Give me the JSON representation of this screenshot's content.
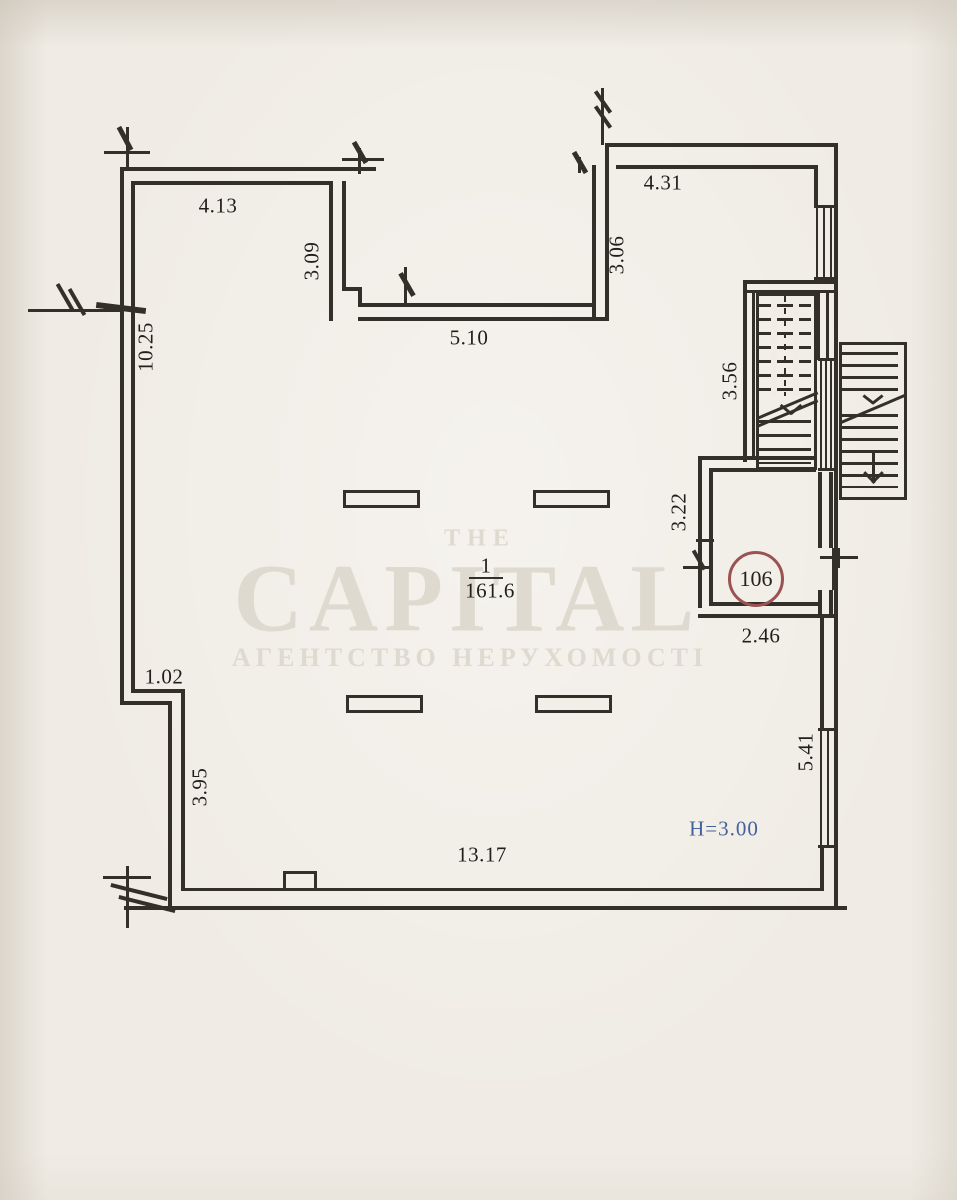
{
  "plan": {
    "dims": {
      "top_left_width": "4.13",
      "partition_height": "3.09",
      "inner_width": "5.10",
      "top_right_width": "4.31",
      "top_right_height": "3.06",
      "left_height": "10.25",
      "stair_height": "3.56",
      "room106_height": "3.22",
      "room106_width": "2.46",
      "left_step": "1.02",
      "left_lower_height": "3.95",
      "right_lower_height": "5.41",
      "bottom_width": "13.17"
    },
    "room_main": {
      "numerator": "1",
      "area": "161.6"
    },
    "room_106": {
      "number": "106"
    },
    "height_note": "H=3.00",
    "watermark": {
      "line_top": "THE",
      "brand": "CAPITAL",
      "subtitle": "АГЕНТСТВО НЕРУХОМОСТІ"
    },
    "colors": {
      "wall": "#33302a",
      "paper": "#f0ece5",
      "accent_blue": "#44619c",
      "circle_red": "#9a5252",
      "watermark": "#dfdacf"
    }
  }
}
